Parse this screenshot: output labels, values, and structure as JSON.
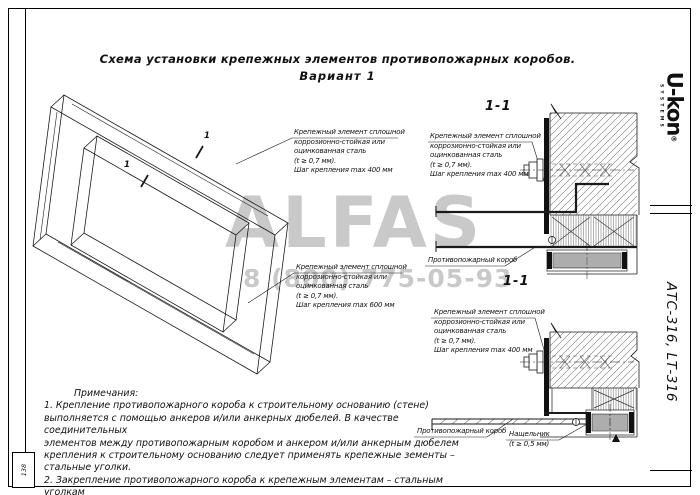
{
  "title": {
    "line1": "Схема установки крепежных элементов противопожарных коробов.",
    "line2": "Вариант 1"
  },
  "watermark": {
    "brand": "ALFAS",
    "phone": "8 (800) 775-05-93"
  },
  "sidebar": {
    "brand": "U-kon",
    "brand_reg": "®",
    "brand_sub": "SYSTEMS",
    "product_code": "АТС-316, LТ-316"
  },
  "stamp": {
    "text": "138"
  },
  "sections": {
    "s1_title": "1-1",
    "s2_title": "1-1"
  },
  "cut_marks": {
    "a": "1",
    "b": "1"
  },
  "annotations": {
    "fastener_top": {
      "lines": [
        "Крепежный элемент сплошной",
        "коррозионно-стойкая или",
        "оцинкованная сталь",
        "(t ≥ 0,7 мм).",
        "Шаг крепления max 400 мм"
      ]
    },
    "fastener_sec1": {
      "lines": [
        "Крепежный элемент сплошной",
        "коррозионно-стойкая или",
        "оцинкованная сталь",
        "(t ≥ 0,7 мм).",
        "Шаг крепления max 400 мм"
      ]
    },
    "fastener_mid": {
      "lines": [
        "Крепежный элемент сплошной",
        "коррозионно-стойкая или",
        "оцинкованная сталь",
        "(t ≥ 0,7 мм).",
        "Шаг крепления max 600 мм"
      ]
    },
    "fastener_sec2": {
      "lines": [
        "Крепежный элемент сплошной",
        "коррозионно-стойкая или",
        "оцинкованная сталь",
        "(t ≥ 0,7 мм).",
        "Шаг крепления max 400 мм"
      ]
    },
    "duct_label_1": "Противопожарный короб",
    "duct_label_2": "Противопожарный короб",
    "flashing_line1": "Нащельник",
    "flashing_line2": "(t ≥ 0,5 мм)"
  },
  "notes": {
    "heading": "Примечания:",
    "lines": [
      "1.  Крепление противопожарного короба к строительному основанию (стене)",
      "выполняется с помощью анкеров и/или анкерных дюбелей. В качестве соединительных",
      "элементов между противопожарным коробом и анкером и/или анкерным дюбелем",
      "крепления к строительному основанию следует применять крепежные зементы –",
      "стальные уголки.",
      "2.  Закрепление противопожарного короба к крепежным элементам – стальным уголкам",
      "выполняется стальными  метизами."
    ]
  },
  "colors": {
    "line": "#1a1a1a",
    "watermark": "#c9c9c9",
    "hatch": "#777777"
  }
}
